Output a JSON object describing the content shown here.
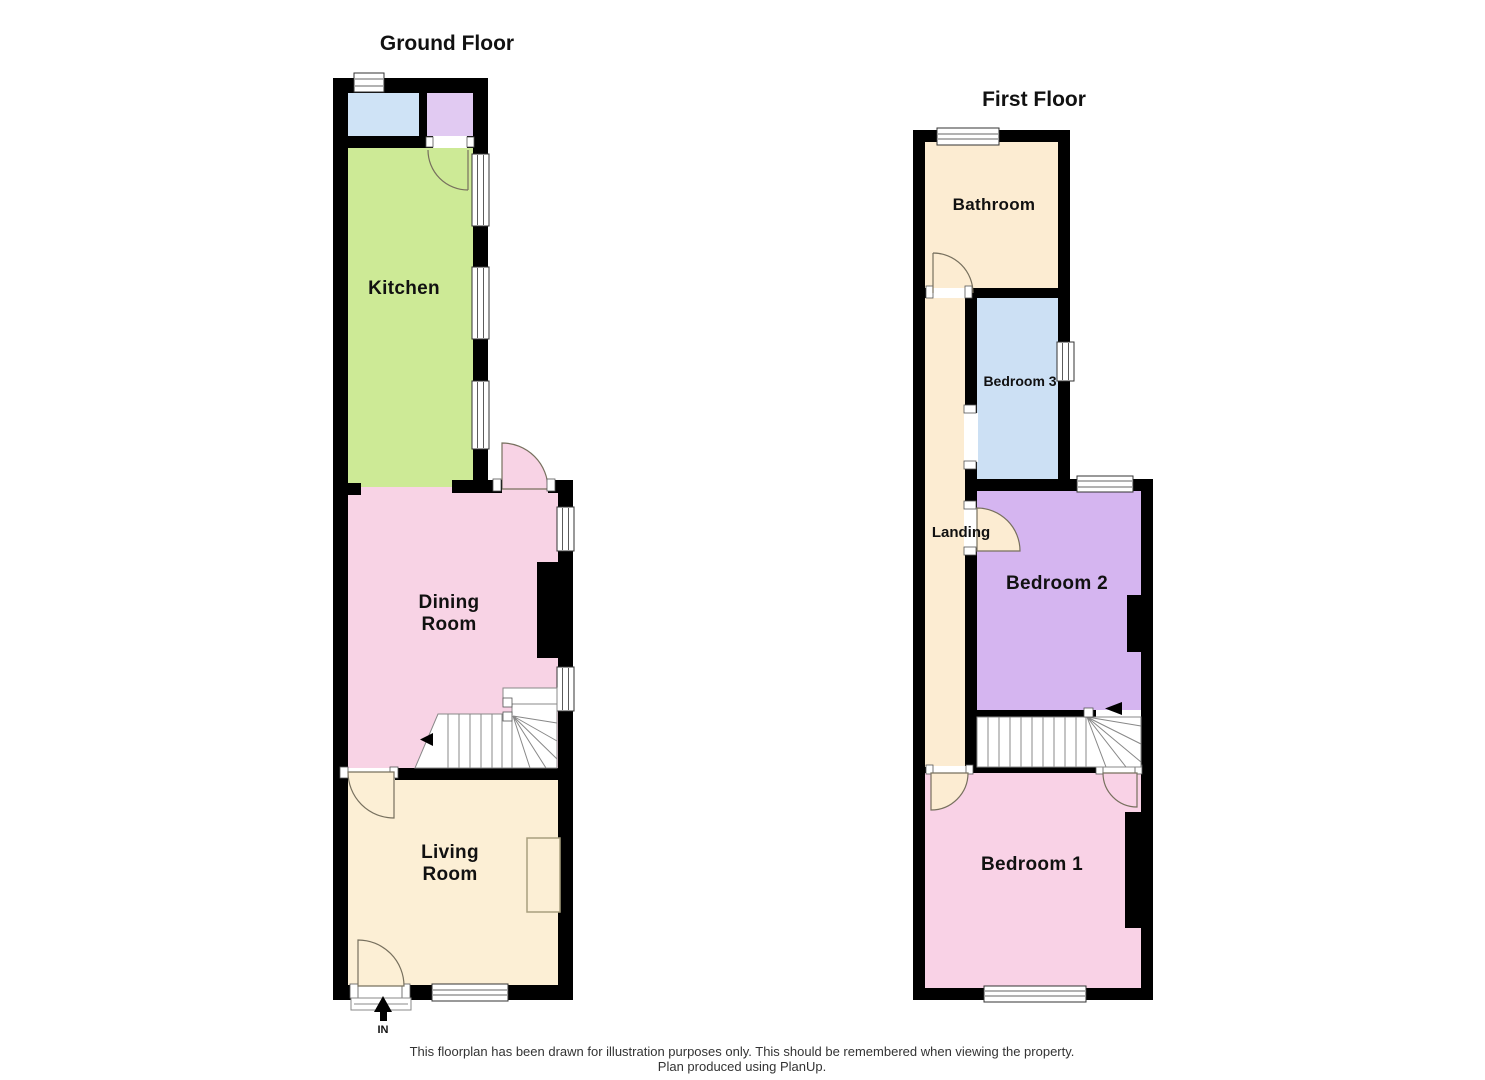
{
  "colors": {
    "wall": "#000000",
    "kitchen": "#cdea96",
    "dining": "#f8d3e5",
    "living": "#fcefd5",
    "room_blue": "#cfe3f6",
    "room_purple": "#e1caf2",
    "bathroom": "#fcecd2",
    "landing": "#fcecd2",
    "bedroom1": "#f9d2e6",
    "bedroom2": "#d5b5f0",
    "bedroom3": "#cce0f4",
    "door_arc": "#77705e"
  },
  "ground_floor": {
    "title": "Ground Floor",
    "kitchen_label": "Kitchen",
    "dining_label_line1": "Dining",
    "dining_label_line2": "Room",
    "living_label_line1": "Living",
    "living_label_line2": "Room",
    "entrance_label": "IN"
  },
  "first_floor": {
    "title": "First Floor",
    "bathroom_label": "Bathroom",
    "bedroom3_label": "Bedroom 3",
    "landing_label": "Landing",
    "bedroom2_label": "Bedroom 2",
    "bedroom1_label": "Bedroom 1"
  },
  "footer": {
    "line1": "This floorplan has been drawn for illustration purposes only. This should be remembered when viewing the property.",
    "line2": "Plan produced using PlanUp."
  }
}
